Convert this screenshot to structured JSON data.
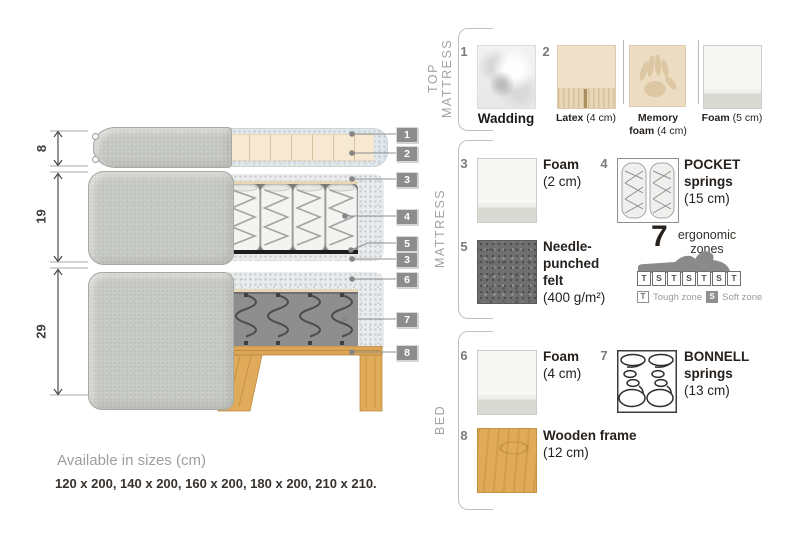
{
  "diagram": {
    "heights": [
      "8",
      "19",
      "29"
    ],
    "callouts": [
      "1",
      "2",
      "3",
      "4",
      "5",
      "3",
      "6",
      "7",
      "8"
    ]
  },
  "legend": {
    "top_mattress": {
      "label": "TOP MATTRESS",
      "items": [
        {
          "num": "1",
          "line1": "Wadding",
          "size": ""
        },
        {
          "num": "2",
          "line1": "Latex",
          "size": "(4 cm)"
        },
        {
          "num": "",
          "line1": "Memory",
          "line2": "foam",
          "size": "(4 cm)"
        },
        {
          "num": "",
          "line1": "Foam",
          "size": "(5 cm)"
        }
      ]
    },
    "mattress": {
      "label": "MATTRESS",
      "items": [
        {
          "num": "3",
          "line1": "Foam",
          "size": "(2 cm)"
        },
        {
          "num": "4",
          "line1": "POCKET",
          "line2": "springs",
          "size": "(15 cm)"
        },
        {
          "num": "5",
          "line1": "Needle-",
          "line2": "punched",
          "line3": "felt",
          "size": "(400 g/m²)"
        }
      ]
    },
    "bed": {
      "label": "BED",
      "items": [
        {
          "num": "6",
          "line1": "Foam",
          "size": "(4 cm)"
        },
        {
          "num": "7",
          "line1": "BONNELL",
          "line2": "springs",
          "size": "(13 cm)"
        },
        {
          "num": "8",
          "line1": "Wooden frame",
          "size": "(12 cm)"
        }
      ]
    }
  },
  "ergonomic": {
    "count": "7",
    "word1": "ergonomic",
    "word2": "zones",
    "zones": [
      "T",
      "S",
      "T",
      "S",
      "T",
      "S",
      "T"
    ],
    "t_key": "T",
    "t_label": "Tough zone",
    "s_key": "S",
    "s_label": "Soft zone"
  },
  "footer": {
    "title": "Available in sizes (cm)",
    "sizes": "120 x 200, 140 x 200, 160 x 200, 180 x 200, 210 x 210."
  }
}
